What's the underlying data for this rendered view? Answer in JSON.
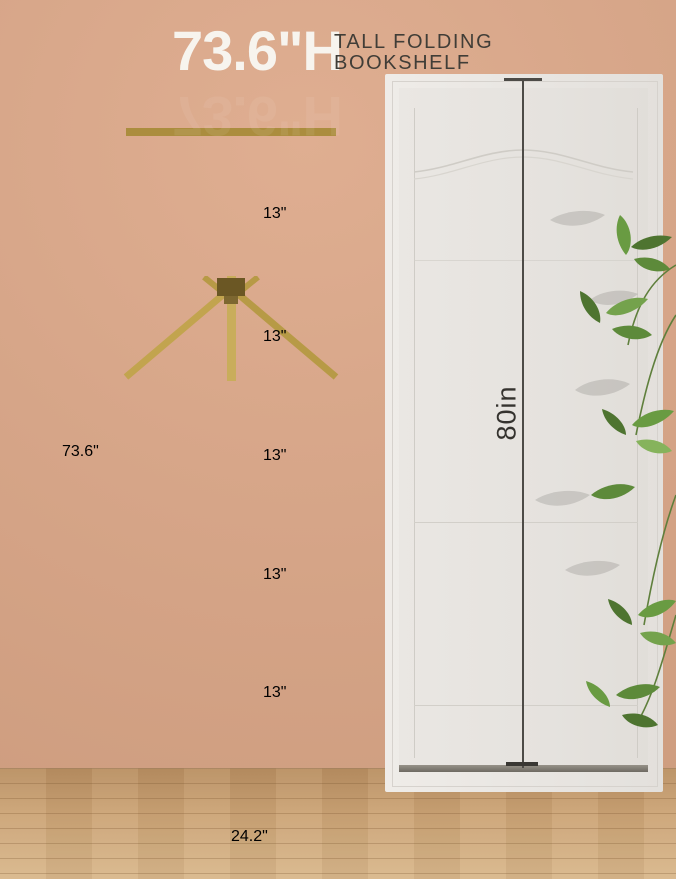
{
  "header": {
    "big": "73.6\"H",
    "sub_line1": "TALL FOLDING",
    "sub_line2": "BOOKSHELF"
  },
  "annotations": {
    "total_height": "73.6\"",
    "width": "24.2\"",
    "door_height": "80in",
    "gaps": [
      "13\"",
      "13\"",
      "13\"",
      "13\"",
      "13\""
    ]
  },
  "objects": {
    "bookshelf": "gold folding 6-tier bookshelf on casters",
    "door": "white paneled door",
    "plant": "bamboo plant leaves"
  },
  "colors": {
    "wall": "#d6a588",
    "shelf_gold": "#c9ab57",
    "door_white": "#e8e5e1",
    "floor_wood": "#cba375",
    "dimension_white": "#ffffff",
    "dimension_dark": "#4d4b47",
    "text_dark": "#403d37",
    "leaf_green": "#5d8a3c"
  }
}
